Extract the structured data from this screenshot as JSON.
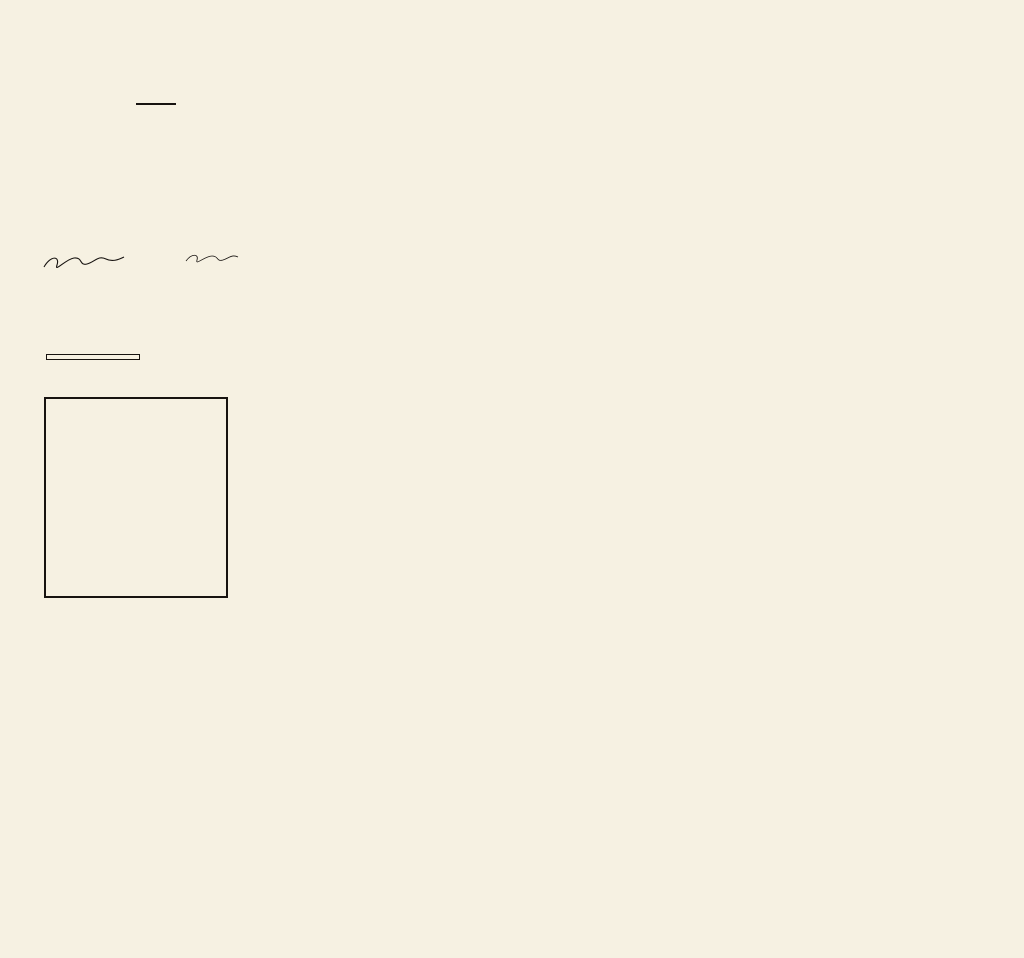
{
  "colors": {
    "paper": "#f6f1e2",
    "ink": "#171310",
    "faded": "#45403a"
  },
  "title": {
    "line1": "PLANO TOPOGRAFICO",
    "line2": "DE LA CIUDAD DE",
    "line3": "CARACAS",
    "line4": "CAPITAL DE LOS EE.UU. DE VENEZUELA"
  },
  "dedication": {
    "l1": "LEVANTADO DE ORDEN DEL",
    "l2": "ILUSTRE AMERICANO GENERAL GUZMAN BLANCO",
    "l3": "PRESIDENTE DE LA REPUBLICA",
    "para": "para servir al Censo y Estadistica del Distrito-Federal bajo la direccion del Presidente de la Junta Directiva del primer Censo de Venezuela y Director de la Estadistica nacional, General Andres A. Level",
    "note": "por el que suscribe",
    "date": "Caracas, Mayo de 1876"
  },
  "stamp": {
    "l1": "COPIA",
    "l2": "OBSEQUIADA POR EL ILUSTRE AMERICANO",
    "l3": "Presidente de Venezuela",
    "l4": "GENERAL ANTONIO GUZMAN BLANCO",
    "l5": "AL CONCEJO MUNICIPAL DEL DTO FEDERAL",
    "l6": "1876"
  },
  "legend": {
    "title": "OBRAS PUBLICAS",
    "sub1": "DECRETADAS DESPUES DEL 27 DE ABRIL",
    "sub2": "DE 1870",
    "items": [
      {
        "name": "Palacio Legislativo",
        "num": "1"
      },
      {
        "name": "Templo Masonico",
        "num": "2"
      },
      {
        "name": "Templo de San Felipe",
        "num": "3"
      },
      {
        "name": "Fachada de la Universidad",
        "num": "4"
      },
      {
        "name": "Plaza Washington",
        "num": "5"
      },
      {
        "name": "Matadero publico",
        "num": "6"
      },
      {
        "name": "Acueducto Guzman Blanco",
        "num": "7"
      },
      {
        "name": "Plaza Guzman Blanco",
        "num": "8"
      },
      {
        "name": "Puente Guzman Blanco",
        "num": "9"
      },
      {
        "name": "Puente Carabobo",
        "num": "10"
      },
      {
        "name": "Puente Calle Amarilla",
        "num": "11"
      },
      {
        "name": "Paseo Guzman Blanco",
        "num": "12"
      },
      {
        "name": "Casa Blanca",
        "num": "13"
      },
      {
        "name": "Composicion de calles",
        "num": ""
      }
    ]
  },
  "cemeteries": {
    "concepcion": [
      "CEMENTERIO DE LA",
      "CONCEPCION"
    ],
    "san_simon": [
      "CEMENTERIO",
      "DE",
      "SAN SIMON"
    ]
  },
  "parishes": [
    {
      "text": "ALTAGRACIA",
      "x": 296,
      "y": 300,
      "rot": 27,
      "size": 13,
      "ls": 9
    },
    {
      "text": "CATEDRAL",
      "x": 506,
      "y": 450,
      "rot": 33,
      "size": 13,
      "ls": 10
    },
    {
      "text": "CANDELARIA",
      "x": 716,
      "y": 326,
      "rot": 83,
      "size": 12,
      "ls": 7
    },
    {
      "text": "SAN PABLO",
      "x": 390,
      "y": 543,
      "rot": 86,
      "size": 12,
      "ls": 7
    },
    {
      "text": "SANTA TERESA",
      "x": 462,
      "y": 590,
      "rot": 87,
      "size": 11,
      "ls": 6
    },
    {
      "text": "SANTA ROSALIA",
      "x": 554,
      "y": 618,
      "rot": 88,
      "size": 11,
      "ls": 6
    },
    {
      "text": "SAN JUAN",
      "x": 286,
      "y": 730,
      "rot": -52,
      "size": 12,
      "ls": 7
    }
  ],
  "places": [
    {
      "text": "LA CUADRA",
      "x": 736,
      "y": 594,
      "rot": 0,
      "size": 6.5,
      "ls": 1
    },
    {
      "text": "HACIENDA SAN BERNARDINO",
      "x": 944,
      "y": 455,
      "rot": -90,
      "size": 6.5,
      "ls": 1.6
    },
    {
      "text": "HACIENDA LA GUIA",
      "x": 974,
      "y": 634,
      "rot": -90,
      "size": 6.5,
      "ls": 1.6
    },
    {
      "text": "RIO GUAIRE",
      "x": 160,
      "y": 790,
      "rot": 17,
      "size": 6,
      "ls": 1
    }
  ],
  "vignettes": [
    {
      "caption": "TEMPLO MASONICO"
    },
    {
      "caption": "UNIVERSIDAD CENTRAL"
    },
    {
      "caption": "PALACIO LEGISLATIVO"
    },
    {
      "caption": "CASA AMARILLA"
    }
  ],
  "scale_label": "ESCALA"
}
